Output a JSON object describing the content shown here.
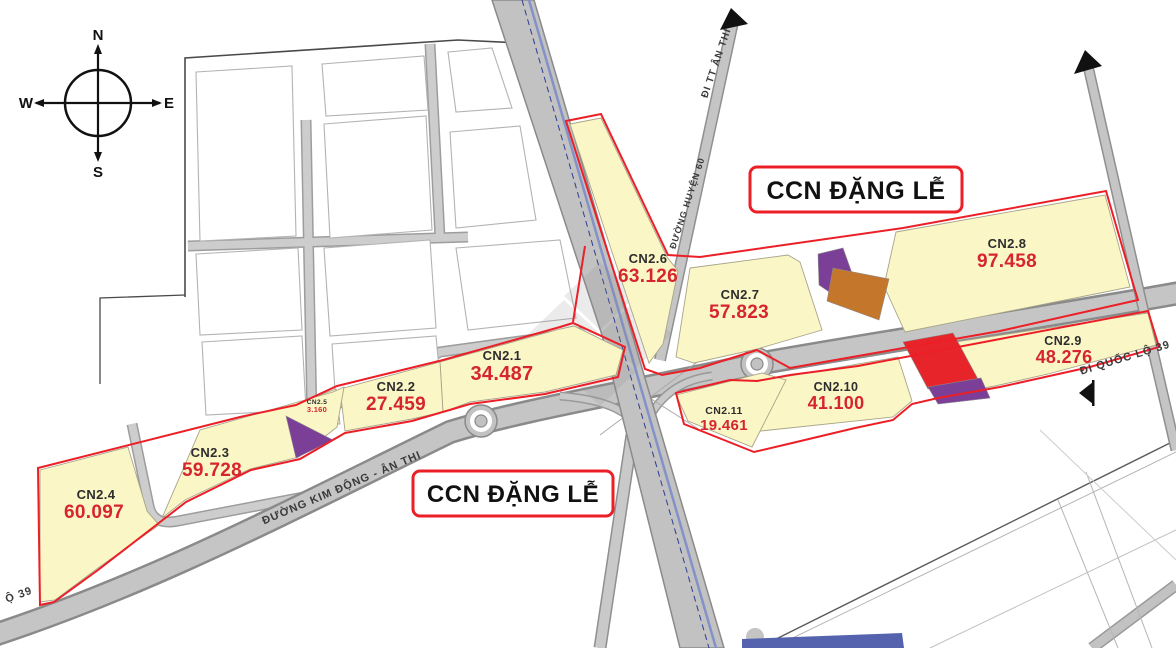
{
  "titles": {
    "zone_box_top": "CCN ĐẶNG LỄ",
    "zone_box_bottom": "CCN ĐẶNG LỄ"
  },
  "compass": {
    "north": "N",
    "east": "E",
    "south": "S",
    "west": "W"
  },
  "parcels": [
    {
      "id": "CN2.1",
      "area": "34.487"
    },
    {
      "id": "CN2.2",
      "area": "27.459"
    },
    {
      "id": "CN2.3",
      "area": "59.728"
    },
    {
      "id": "CN2.4",
      "area": "60.097"
    },
    {
      "id": "CN2.5",
      "area": "3.160"
    },
    {
      "id": "CN2.6",
      "area": "63.126"
    },
    {
      "id": "CN2.7",
      "area": "57.823"
    },
    {
      "id": "CN2.8",
      "area": "97.458"
    },
    {
      "id": "CN2.9",
      "area": "48.276"
    },
    {
      "id": "CN2.10",
      "area": "41.100"
    },
    {
      "id": "CN2.11",
      "area": "19.461"
    }
  ],
  "road_labels": {
    "to_tt_an_thi": "ĐI TT ÂN THI",
    "duong_huyen_60": "ĐƯỜNG HUYỆN 60",
    "duong_kim_dong_an_thi": "ĐƯỜNG KIM ĐỘNG - ÂN THI",
    "di_quoc_lo_39": "ĐI QUỐC LỘ 39",
    "quoc_lo_39_partial": "Ộ 39"
  },
  "colors": {
    "parcel_fill": "#faf6c6",
    "boundary_red": "#ec1f27",
    "area_value_red": "#d6252e",
    "road_gray": "#c5c5c5",
    "purple": "#7b3f97",
    "orange": "#c4772b",
    "highlight_red": "#e8242b",
    "highway_blue": "#8391c9"
  }
}
